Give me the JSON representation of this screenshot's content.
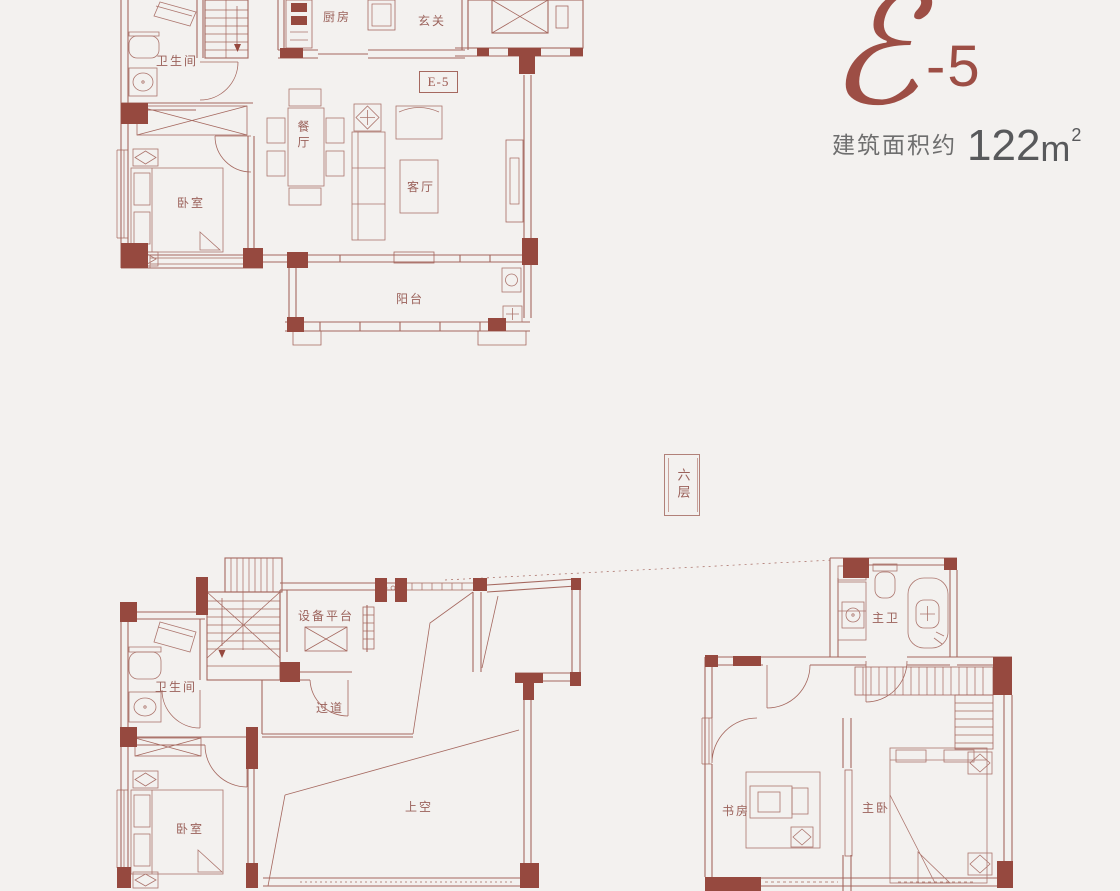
{
  "header": {
    "logo_letter": "ℰ",
    "logo_suffix": "-5",
    "area_label": "建筑面积约",
    "area_value": "122",
    "area_unit": "m",
    "area_exponent": "2"
  },
  "badges": {
    "floor": "六层",
    "unit": "E-5"
  },
  "rooms": {
    "upper": {
      "bathroom": "卫生间",
      "kitchen": "厨房",
      "entry": "玄关",
      "dining": "餐厅",
      "living": "客厅",
      "bedroom": "卧室",
      "balcony": "阳台"
    },
    "lower_left": {
      "equipment_platform": "设备平台",
      "bathroom": "卫生间",
      "corridor": "过道",
      "bedroom": "卧室",
      "void": "上空"
    },
    "lower_right": {
      "master_bath": "主卫",
      "study": "书房",
      "master_bedroom": "主卧"
    }
  },
  "colors": {
    "background": "#f3f1ef",
    "wall_fill": "#96493f",
    "line": "#a5685f",
    "furniture_line": "#ac756d",
    "label_text": "#9b625b",
    "logo": "#9d4e45",
    "area_text": "#6e6e6e"
  }
}
